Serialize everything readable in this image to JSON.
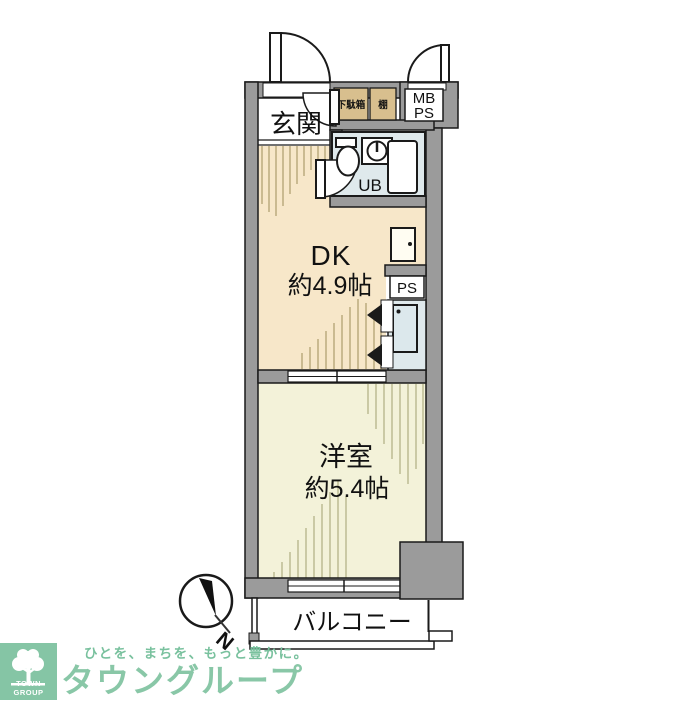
{
  "floorplan": {
    "entrance_label": "玄関",
    "shoe_box_label": "下駄箱",
    "shelf_label": "棚",
    "meter_box_line1": "MB",
    "meter_box_line2": "PS",
    "unit_bath_label": "UB",
    "dk_label": "DK",
    "dk_size": "約4.9帖",
    "pipe_space_label": "PS",
    "western_room_label": "洋室",
    "western_room_size": "約5.4帖",
    "balcony_label": "バルコニー",
    "compass_label": "N"
  },
  "branding": {
    "tagline": "ひとを、まちを、もっと豊かに。",
    "company_name": "タウングループ",
    "logo_caption": "TOWN GROUP"
  },
  "colors": {
    "wall_gray": "#9b9b9b",
    "dk_floor": "#f7e7c9",
    "western_room_floor": "#f3f2d9",
    "cabinet_tan": "#d8bf8e",
    "bath_blue": "#dfe9ec",
    "brand_green": "#85c5a5",
    "line_black": "#1a1a1a"
  }
}
